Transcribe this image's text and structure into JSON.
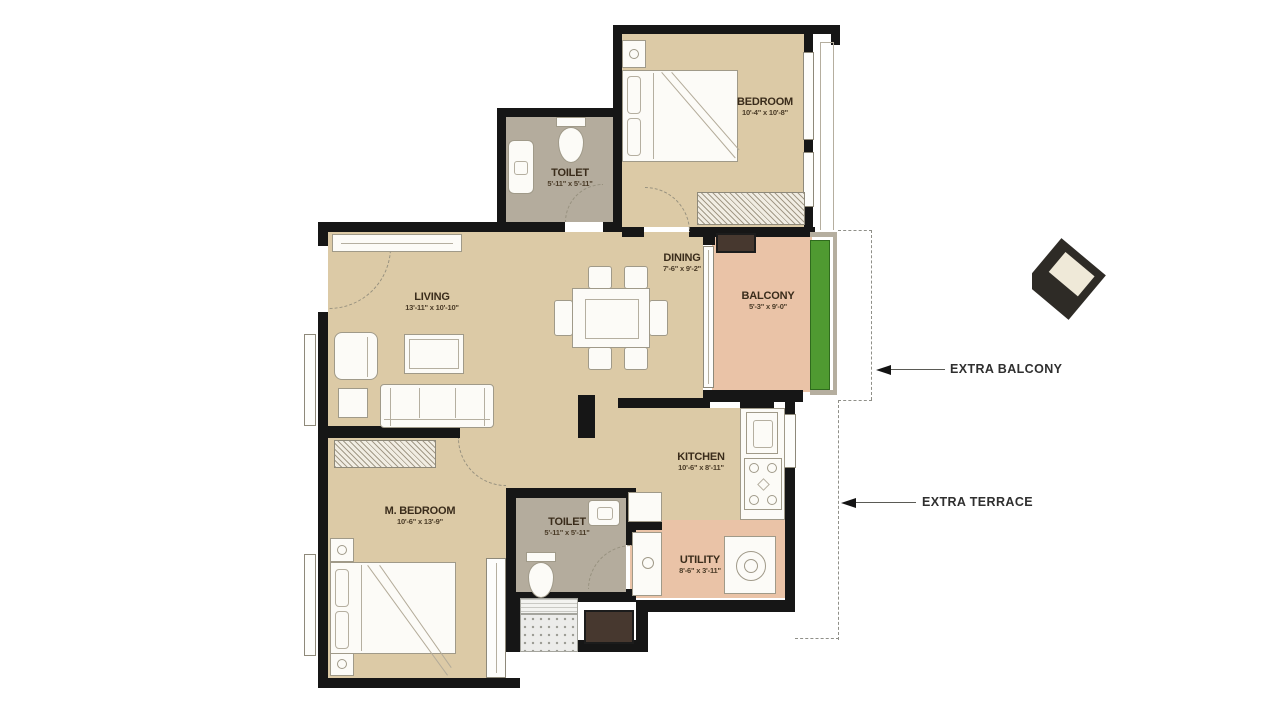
{
  "plan": {
    "rooms": [
      {
        "name": "BEDROOM",
        "dims": "10'-4\" x 10'-8\""
      },
      {
        "name": "TOILET",
        "dims": "5'-11\" x 5'-11\""
      },
      {
        "name": "LIVING",
        "dims": "13'-11\" x 10'-10\""
      },
      {
        "name": "DINING",
        "dims": "7'-6\" x 9'-2\""
      },
      {
        "name": "BALCONY",
        "dims": "5'-3\" x 9'-0\""
      },
      {
        "name": "KITCHEN",
        "dims": "10'-6\" x 8'-11\""
      },
      {
        "name": "M. BEDROOM",
        "dims": "10'-6\" x 13'-9\""
      },
      {
        "name": "TOILET",
        "dims": "5'-11\" x 5'-11\""
      },
      {
        "name": "UTILITY",
        "dims": "8'-6\" x 3'-11\""
      }
    ],
    "annotations": [
      {
        "label": "EXTRA BALCONY"
      },
      {
        "label": "EXTRA TERRACE"
      }
    ],
    "colors": {
      "wall": "#161616",
      "floor": "#dccaa6",
      "wet_floor": "#b4ac9d",
      "balcony_floor": "#eac3a7",
      "planter_green": "#4f9a31",
      "label_text": "#3a2c1b",
      "annotation_text": "#2f2f2f"
    }
  }
}
